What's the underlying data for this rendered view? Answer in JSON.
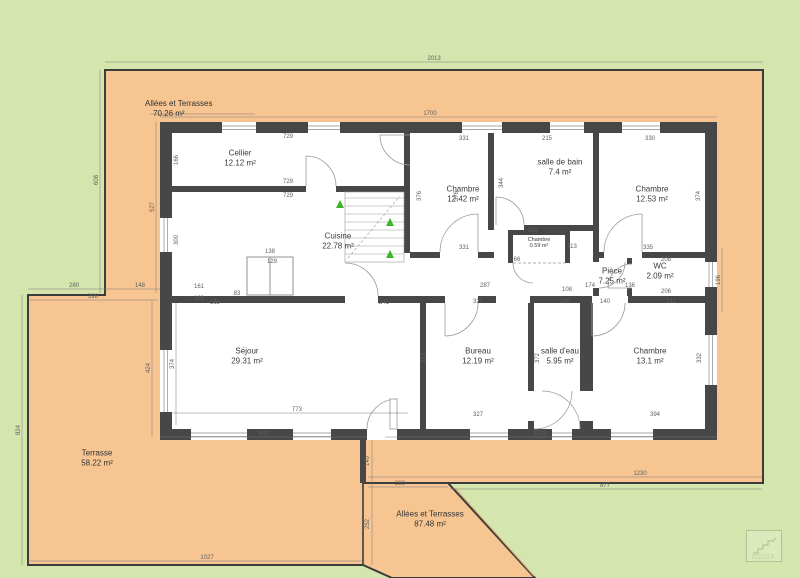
{
  "colors": {
    "grass": "#d4e6ae",
    "paving": "#f6c592",
    "wall": "#474747",
    "outline": "#3c3c3c",
    "dimension_text": "#5f5f5f",
    "room_text": "#3a3a3a",
    "stairs_arrow": "#3db32a"
  },
  "zones": {
    "alley_top": {
      "name": "Allées et Terrasses",
      "area": "70.26 m²"
    },
    "terrasse": {
      "name": "Terrasse",
      "area": "58.22 m²"
    },
    "alley_bottom": {
      "name": "Allées et Terrasses",
      "area": "87.48 m²"
    }
  },
  "rooms": [
    {
      "id": "cellier",
      "name": "Cellier",
      "area": "12.12 m²",
      "x": 240,
      "y": 158
    },
    {
      "id": "cuisine",
      "name": "Cuisine",
      "area": "22.78 m²",
      "x": 338,
      "y": 241
    },
    {
      "id": "chambre-1",
      "name": "Chambre",
      "area": "12.42 m²",
      "x": 463,
      "y": 194
    },
    {
      "id": "salle-de-bain",
      "name": "salle de bain",
      "area": "7.4 m²",
      "x": 560,
      "y": 167
    },
    {
      "id": "chambre-2",
      "name": "Chambre",
      "area": "12.53 m²",
      "x": 652,
      "y": 194
    },
    {
      "id": "placard",
      "name": "Chambre",
      "area": "0.59 m²",
      "x": 539,
      "y": 243
    },
    {
      "id": "piece",
      "name": "Pièce",
      "area": "7.25 m²",
      "x": 612,
      "y": 276
    },
    {
      "id": "wc",
      "name": "WC",
      "area": "2.09 m²",
      "x": 660,
      "y": 271
    },
    {
      "id": "sejour",
      "name": "Séjour",
      "area": "29.31 m²",
      "x": 247,
      "y": 356
    },
    {
      "id": "bureau",
      "name": "Bureau",
      "area": "12.19 m²",
      "x": 478,
      "y": 356
    },
    {
      "id": "salle-d-eau",
      "name": "salle d'eau",
      "area": "5.95 m²",
      "x": 560,
      "y": 356
    },
    {
      "id": "chambre-3",
      "name": "Chambre",
      "area": "13.1 m²",
      "x": 650,
      "y": 356
    }
  ],
  "dimensions": [
    {
      "t": "2013",
      "x": 434,
      "y": 59
    },
    {
      "t": "1700",
      "x": 430,
      "y": 114
    },
    {
      "t": "608",
      "x": 97,
      "y": 180,
      "r": 1
    },
    {
      "t": "527",
      "x": 153,
      "y": 207,
      "r": 1
    },
    {
      "t": "824",
      "x": 19,
      "y": 430,
      "r": 1
    },
    {
      "t": "1027",
      "x": 207,
      "y": 558
    },
    {
      "t": "1230",
      "x": 640,
      "y": 474
    },
    {
      "t": "877",
      "x": 605,
      "y": 486
    },
    {
      "t": "293",
      "x": 400,
      "y": 484
    },
    {
      "t": "632",
      "x": 264,
      "y": 434
    },
    {
      "t": "1013",
      "x": 540,
      "y": 434
    },
    {
      "t": "773",
      "x": 297,
      "y": 410
    },
    {
      "t": "280",
      "x": 74,
      "y": 286
    },
    {
      "t": "148",
      "x": 140,
      "y": 286
    },
    {
      "t": "398",
      "x": 93,
      "y": 297
    },
    {
      "t": "424",
      "x": 149,
      "y": 368,
      "r": 1
    },
    {
      "t": "374",
      "x": 173,
      "y": 364,
      "r": 1
    },
    {
      "t": "196",
      "x": 719,
      "y": 280,
      "r": 1
    },
    {
      "t": "140",
      "x": 368,
      "y": 461,
      "r": 1
    },
    {
      "t": "252",
      "x": 368,
      "y": 524,
      "r": 1
    },
    {
      "t": "729",
      "x": 288,
      "y": 137
    },
    {
      "t": "729",
      "x": 288,
      "y": 182
    },
    {
      "t": "729",
      "x": 288,
      "y": 196
    },
    {
      "t": "166",
      "x": 177,
      "y": 160,
      "r": 1
    },
    {
      "t": "300",
      "x": 177,
      "y": 240,
      "r": 1
    },
    {
      "t": "331",
      "x": 464,
      "y": 139
    },
    {
      "t": "331",
      "x": 464,
      "y": 248
    },
    {
      "t": "376",
      "x": 420,
      "y": 196,
      "r": 1
    },
    {
      "t": "376",
      "x": 457,
      "y": 196,
      "r": 1
    },
    {
      "t": "215",
      "x": 547,
      "y": 139
    },
    {
      "t": "344",
      "x": 502,
      "y": 183,
      "r": 1
    },
    {
      "t": "330",
      "x": 650,
      "y": 139
    },
    {
      "t": "335",
      "x": 648,
      "y": 248
    },
    {
      "t": "374",
      "x": 699,
      "y": 196,
      "r": 1
    },
    {
      "t": "102",
      "x": 533,
      "y": 231
    },
    {
      "t": "113",
      "x": 572,
      "y": 247
    },
    {
      "t": "66",
      "x": 517,
      "y": 260
    },
    {
      "t": "287",
      "x": 485,
      "y": 286
    },
    {
      "t": "108",
      "x": 567,
      "y": 290
    },
    {
      "t": "174",
      "x": 590,
      "y": 286
    },
    {
      "t": "136",
      "x": 630,
      "y": 286
    },
    {
      "t": "208",
      "x": 666,
      "y": 260
    },
    {
      "t": "206",
      "x": 666,
      "y": 292
    },
    {
      "t": "327",
      "x": 478,
      "y": 302
    },
    {
      "t": "160",
      "x": 565,
      "y": 302
    },
    {
      "t": "140",
      "x": 605,
      "y": 302
    },
    {
      "t": "211",
      "x": 671,
      "y": 302
    },
    {
      "t": "163",
      "x": 215,
      "y": 303
    },
    {
      "t": "241",
      "x": 384,
      "y": 303
    },
    {
      "t": "83",
      "x": 237,
      "y": 294
    },
    {
      "t": "161",
      "x": 199,
      "y": 287
    },
    {
      "t": "163",
      "x": 199,
      "y": 299
    },
    {
      "t": "327",
      "x": 478,
      "y": 415
    },
    {
      "t": "394",
      "x": 655,
      "y": 415
    },
    {
      "t": "373",
      "x": 424,
      "y": 358,
      "r": 1
    },
    {
      "t": "372",
      "x": 538,
      "y": 358,
      "r": 1
    },
    {
      "t": "332",
      "x": 700,
      "y": 358,
      "r": 1
    },
    {
      "t": "138",
      "x": 270,
      "y": 252
    },
    {
      "t": "129",
      "x": 272,
      "y": 262
    }
  ]
}
